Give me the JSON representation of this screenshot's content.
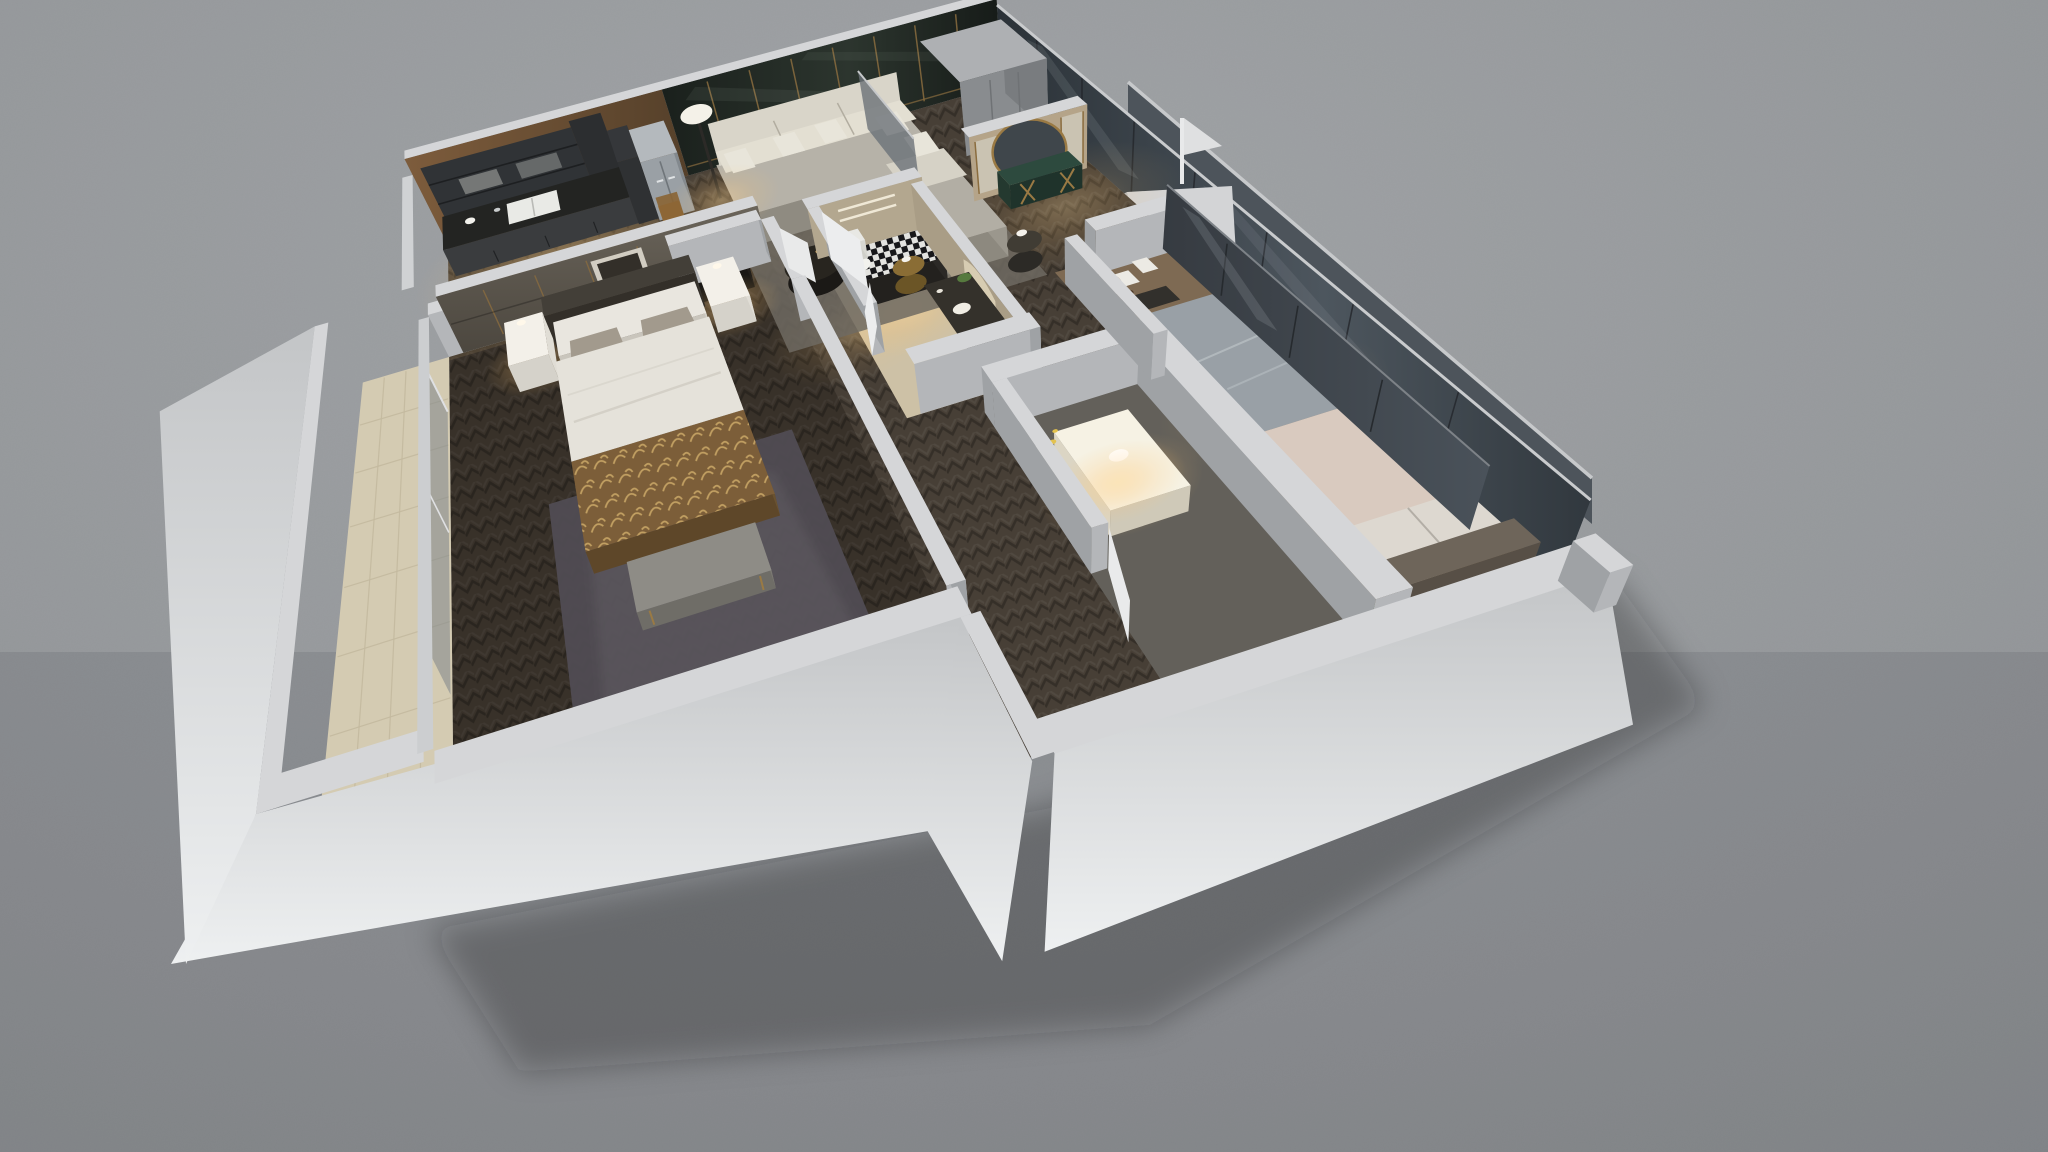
{
  "scene": {
    "title": "3D cutaway floor-plan render of a two-bedroom apartment, evening interior lighting",
    "view": "isometric dollhouse top-down perspective",
    "background": "plain gray ground plane"
  },
  "palette": {
    "background": "#97999c",
    "wall_top": "#d5d6d8",
    "wall_face_light": "#eef0f1",
    "wall_face_mid": "#b4b6b9",
    "wall_face_shadow": "#9fa2a5",
    "marble_wall": "#202723",
    "gold_trim": "#8a6c3e",
    "herringbone_floor": "#473f36",
    "master_floor": "#3b342c",
    "balcony_tile": "#d4cbb2",
    "sofa": "#b6b2a8",
    "sofa_cushion_lit": "#e3dfd2",
    "bed_linen": "#e5e2da",
    "blanket_brown": "#7c5e39",
    "blanket_pattern": "#c2a163",
    "rug_master": "#504c53",
    "travertine": "#b3a78f",
    "bath2_tile": "#76736d",
    "glass_facade": "#394046",
    "wardrobe_glass": "#3f444b",
    "warm_light": "#f3cf96",
    "bedroom2_duvet": "#99a0a6",
    "bedroom2_throw": "#d9cabf",
    "wood_platform": "#7e6a53",
    "kitchen_wood": "#6b4e33",
    "cabinet_dark": "#303336",
    "fridge_steel": "#9aa0a5",
    "green_marble": "#2d4a3e"
  },
  "rooms": [
    {
      "id": "kitchen",
      "label": "Kitchen",
      "furniture": [
        "upper cabinets",
        "double sink counter",
        "tall cabinet",
        "fridge"
      ]
    },
    {
      "id": "living-dining",
      "label": "Living / Dining",
      "furniture": [
        "marble feature wall",
        "L-shaped sofa",
        "throw pillows",
        "houndstooth ottoman",
        "coffee table",
        "gold side table",
        "floor lamp",
        "dining table",
        "dining chairs",
        "area rug"
      ]
    },
    {
      "id": "entry-hall",
      "label": "Entry Hall",
      "furniture": [
        "closet blocks",
        "glass divider",
        "console table",
        "round mirror"
      ]
    },
    {
      "id": "master-bedroom",
      "label": "Master Bedroom",
      "furniture": [
        "headboard feature wall",
        "wall art",
        "double bed",
        "nightstands",
        "bench",
        "shag rug",
        "balcony sliding door"
      ]
    },
    {
      "id": "bathroom-1",
      "label": "Bathroom",
      "furniture": [
        "toilet",
        "vanity with plant",
        "arched niche",
        "door"
      ]
    },
    {
      "id": "bathroom-2",
      "label": "Shower Room",
      "furniture": [
        "lit vanity",
        "mirror",
        "door"
      ]
    },
    {
      "id": "bedroom-2",
      "label": "Second Bedroom",
      "furniture": [
        "platform bed",
        "beanbag",
        "desk ledge",
        "glass-door wardrobe",
        "side units",
        "plant"
      ]
    },
    {
      "id": "balcony",
      "label": "Balcony",
      "furniture": [
        "beige tiled floor",
        "parapet wall"
      ]
    }
  ],
  "exterior": {
    "features": [
      "east glass facade",
      "north-east glass railing",
      "service ledge",
      "white column",
      "flag finial",
      "soft ground shadow"
    ]
  }
}
